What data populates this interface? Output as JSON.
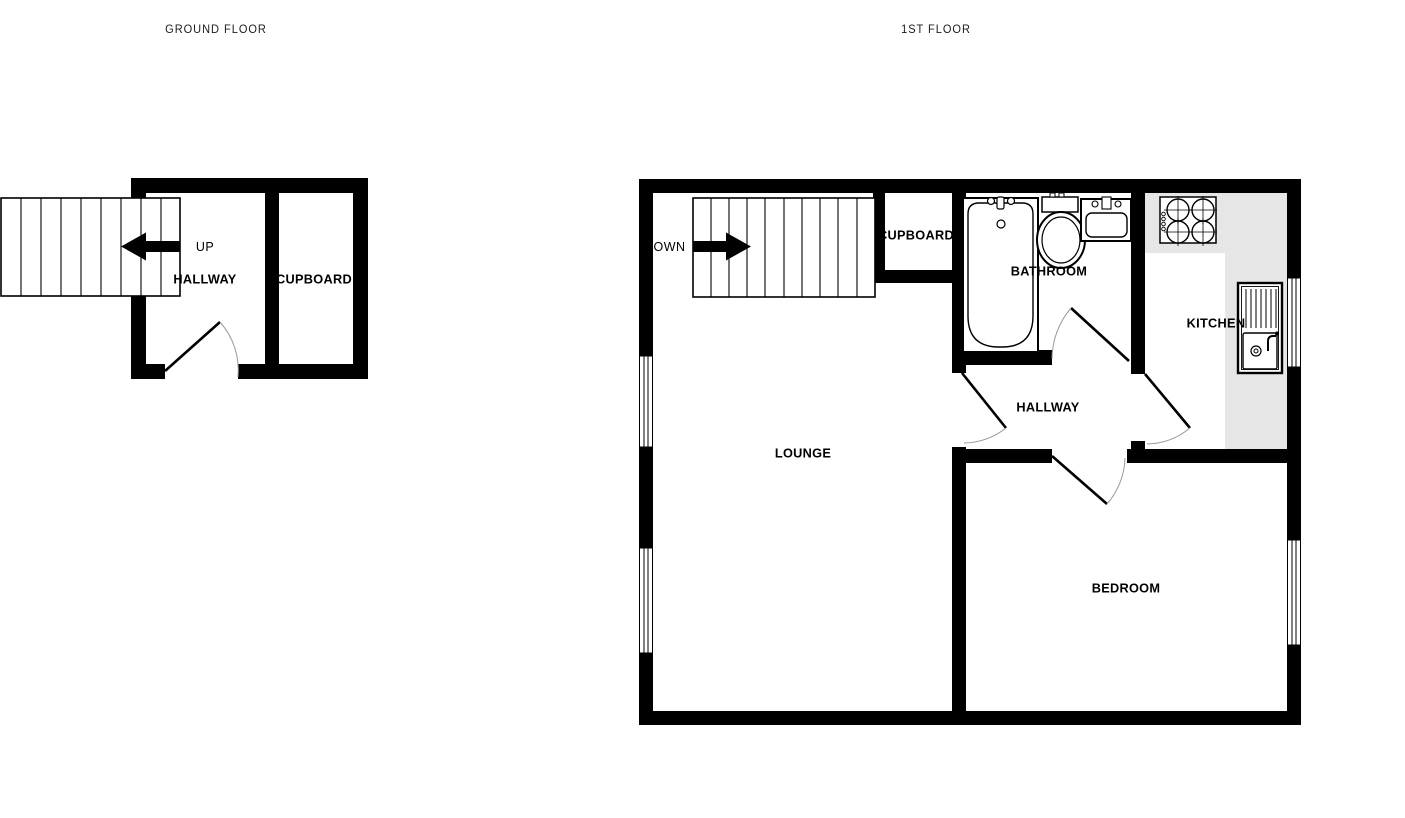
{
  "colors": {
    "wall": "#000000",
    "floor": "#ffffff",
    "counter": "#e6e6e6",
    "door_arc": "#999999"
  },
  "icons": [
    "stairs-up-icon",
    "stairs-down-icon",
    "bath-icon",
    "toilet-icon",
    "basin-icon",
    "hob-icon",
    "kitchen-sink-icon",
    "window-icon",
    "door-icon"
  ],
  "ground_floor": {
    "title": "GROUND FLOOR",
    "stairs_direction": "UP",
    "rooms": {
      "hallway": "HALLWAY",
      "cupboard": "CUPBOARD"
    }
  },
  "first_floor": {
    "title": "1ST FLOOR",
    "stairs_direction": "DOWN",
    "rooms": {
      "cupboard": "CUPBOARD",
      "bathroom": "BATHROOM",
      "kitchen": "KITCHEN",
      "hallway": "HALLWAY",
      "lounge": "LOUNGE",
      "bedroom": "BEDROOM"
    }
  }
}
